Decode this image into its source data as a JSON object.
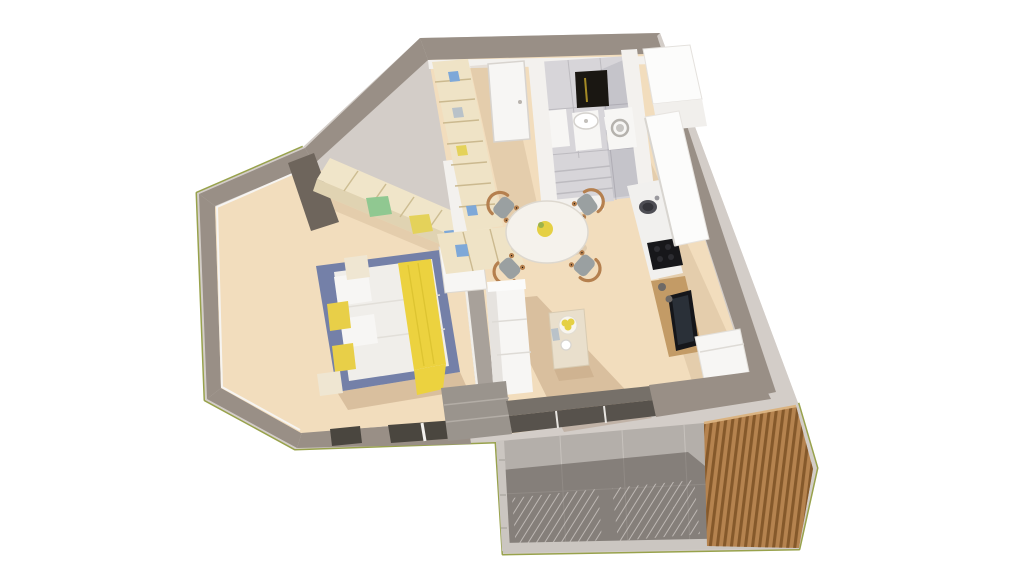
{
  "scene": {
    "description": "3D perspective render of a one-bedroom apartment floor plan viewed from above on a white background",
    "render_style": "architectural dollhouse cutaway"
  },
  "colors": {
    "bg": "#ffffff",
    "wall_top": "#998f86",
    "wall_top_dark": "#6e655c",
    "wall_outer": "#d3cdc8",
    "wall_inner": "#f3f1ee",
    "grass": "#98a24c",
    "wood_floor": "#f2ddbd",
    "wood_shadow": "rgba(139,98,62,0.24)",
    "wood_shadow_light": "rgba(139,98,62,0.13)",
    "bath_floor": "#d7d5d9",
    "bath_stripe": "#bdbbc0",
    "balcony_floor": "#b4afaa",
    "balcony_shadow": "rgba(62,56,50,0.40)",
    "balcony_grout": "#c7c2bd",
    "railing": "#cbc6c1",
    "deck_wood": "#b5834f",
    "deck_slat": "#85592b",
    "deck_highlight": "#dab381",
    "glass_dark": "#57524c",
    "door_track": "#767069",
    "white_furniture": "#f7f6f4",
    "sofa_shadow_side": "#e6e3df",
    "bed_frame": "#7480a8",
    "mattress": "#f0eeea",
    "blanket_yellow": "#ecd23f",
    "pillow_yellow": "#e8cf48",
    "wardrobe_top": "#f0e5c9",
    "wardrobe_face": "#e0d3b2",
    "shelf_wood": "#efe3c6",
    "item_green": "#90c891",
    "item_blue": "#7ea8d8",
    "item_tan": "#e4d25a",
    "item_gray": "#b9c2c9",
    "chair_seat": "#9aa0a1",
    "chair_wood": "#b5804f",
    "table_white": "#f5f2ec",
    "lemon": "#e5d044",
    "leaf_green": "#9db34a",
    "counter_white": "#f1f0ee",
    "cabinet_white": "#fcfcfb",
    "appliance_black": "#17171a",
    "sink_dark": "#4e4e54",
    "tv_black": "#15161a",
    "tv_screen": "#2a3038",
    "mirror_dark": "#1a1712",
    "mirror_gold": "#a58a25",
    "sideboard_wood": "#c39b66",
    "speaker_gray": "#6f6a66",
    "nightstand": "#efe6d2",
    "window_dark": "#4a463f",
    "step_gray": "#9a948d",
    "coffee_table": "#e9dfcc"
  },
  "rooms": {
    "bedroom": {
      "name": "bedroom",
      "items": [
        "wardrobe",
        "double-bed",
        "yellow-throw-blanket",
        "pillows",
        "nightstand-left",
        "nightstand-right",
        "windows"
      ]
    },
    "hallway": {
      "name": "entry-hall",
      "items": [
        "entry-door",
        "shelving-unit",
        "lower-shelf"
      ]
    },
    "bathroom": {
      "name": "bathroom",
      "items": [
        "mirror",
        "washbasin",
        "toilet",
        "cabinet",
        "shower-floor"
      ]
    },
    "kitchen": {
      "name": "kitchen",
      "items": [
        "tall-cabinet",
        "washing-machine",
        "upper-cabinet",
        "countertop",
        "sink",
        "cooktop"
      ]
    },
    "living_dining": {
      "name": "living-dining-room",
      "items": [
        "round-dining-table",
        "dining-chairs",
        "fruit-bowl",
        "coffee-table",
        "sofa",
        "tv",
        "tv-sideboard",
        "armchair",
        "sliding-glass-door"
      ]
    },
    "balcony": {
      "name": "balcony",
      "items": [
        "tiled-floor",
        "railing",
        "wooden-slat-screen",
        "grass-edge"
      ]
    }
  }
}
